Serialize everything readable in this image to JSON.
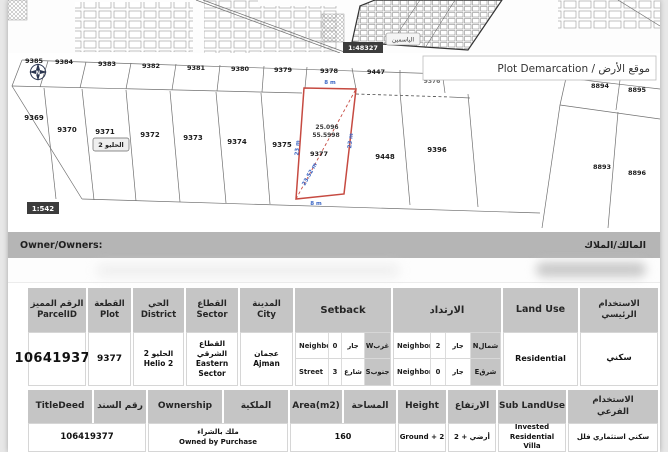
{
  "overview": {
    "scale_badge": "1:48327",
    "district_label": "الياسمين"
  },
  "plot_map": {
    "title": "Plot Demarcation / موقع الأرض",
    "scale_badge": "1:542",
    "compass_n": "N",
    "district_badge": "الحليو 2",
    "plots_top": [
      "9385",
      "9384",
      "9383",
      "9382",
      "9381",
      "9380",
      "9379",
      "9378",
      "9447",
      "9376"
    ],
    "plots_bottom": [
      "9369",
      "9370",
      "9371",
      "9372",
      "9373",
      "9374",
      "9375",
      "9448",
      "9396"
    ],
    "plots_right": [
      "8894",
      "8895",
      "8893",
      "8896"
    ],
    "selected": {
      "number": "9377",
      "coord1": "25.096",
      "coord2": "55.5998",
      "dim_top": "8 m",
      "dim_bottom": "8 m",
      "dim_left": "23 m",
      "dim_right": "23 m",
      "dim_diagonal": "23.52 m"
    }
  },
  "owner": {
    "label_en": "Owner/Owners:",
    "label_ar": "المالك/الملاك"
  },
  "table1": {
    "headers": {
      "parcel": {
        "ar": "الرقم المميز",
        "en": "ParcelID"
      },
      "plot": {
        "ar": "القطعة",
        "en": "Plot"
      },
      "district": {
        "ar": "الحي",
        "en": "District"
      },
      "sector": {
        "ar": "القطاع",
        "en": "Sector"
      },
      "city": {
        "ar": "المدينة",
        "en": "City"
      },
      "setback": "Setback",
      "irtidad": "الارتداد",
      "landuse": "Land Use",
      "primary_use": "الاستخدام الرئيسي"
    },
    "row": {
      "parcel_id": "106419377",
      "plot": "9377",
      "district": {
        "ar": "الحليو 2",
        "en": "Helio 2"
      },
      "sector": {
        "ar": "القطاع الشرقي",
        "en": "Eastern Sector"
      },
      "city": {
        "ar": "عجمان",
        "en": "Ajman"
      },
      "setback": {
        "rows": [
          {
            "type": "Neighbor",
            "value": "0",
            "ar": "جار",
            "dir": "غربW"
          },
          {
            "type": "Street",
            "value": "3",
            "ar": "شارع",
            "dir": "جنوبS"
          }
        ]
      },
      "irtidad": {
        "rows": [
          {
            "type": "Neighbor",
            "value": "2",
            "ar": "جار",
            "dir": "شمالN"
          },
          {
            "type": "Neighbor",
            "value": "0",
            "ar": "جار",
            "dir": "شرقE"
          }
        ]
      },
      "landuse_en": "Residential",
      "landuse_ar": "سكني"
    }
  },
  "table2": {
    "headers": {
      "titledeed_en": "TitleDeed",
      "titledeed_ar": "رقم السند",
      "ownership_en": "Ownership",
      "ownership_ar": "الملكية",
      "area_en": "Area(m2)",
      "area_ar": "المساحة",
      "height_en": "Height",
      "height_ar": "الارتفاع",
      "sub_en": "Sub LandUse",
      "sub_ar": "الاستخدام الفرعي"
    },
    "row": {
      "title_deed": "106419377",
      "ownership_ar": "ملك بالشراء",
      "ownership_en": "Owned by Purchase",
      "area": "160",
      "height_en": "Ground + 2",
      "height_ar": "أرضي + 2",
      "sub_en": "Invested Residential Villa",
      "sub_ar": "سكني استثماري فلل"
    }
  },
  "colors": {
    "accent_red": "#c64a41",
    "dim_blue": "#3b66c4"
  }
}
